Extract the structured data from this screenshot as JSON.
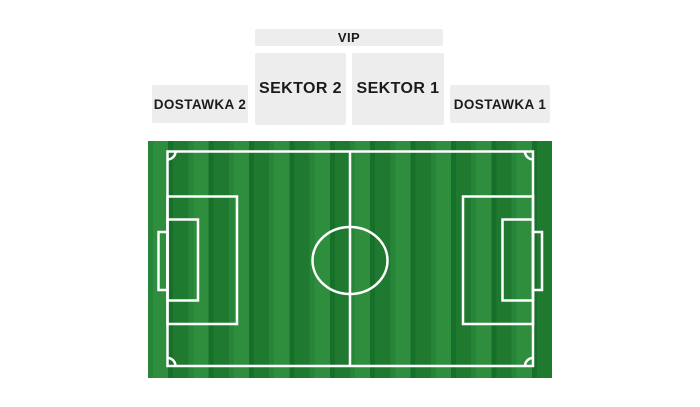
{
  "colors": {
    "page_bg": "#ffffff",
    "section_bg": "#ededed",
    "section_text": "#1b1b1b",
    "grass_light": "#2e8e3d",
    "grass_light_edge": "#27853a",
    "grass_dark": "#1f7a30",
    "grass_dark_edge": "#177029",
    "line_color": "#ffffff"
  },
  "seating_map": {
    "sections": {
      "vip": {
        "label": "VIP"
      },
      "sektor2": {
        "label": "SEKTOR 2"
      },
      "sektor1": {
        "label": "SEKTOR 1"
      },
      "dostawka2": {
        "label": "DOSTAWKA 2"
      },
      "dostawka1": {
        "label": "DOSTAWKA 1"
      }
    }
  }
}
